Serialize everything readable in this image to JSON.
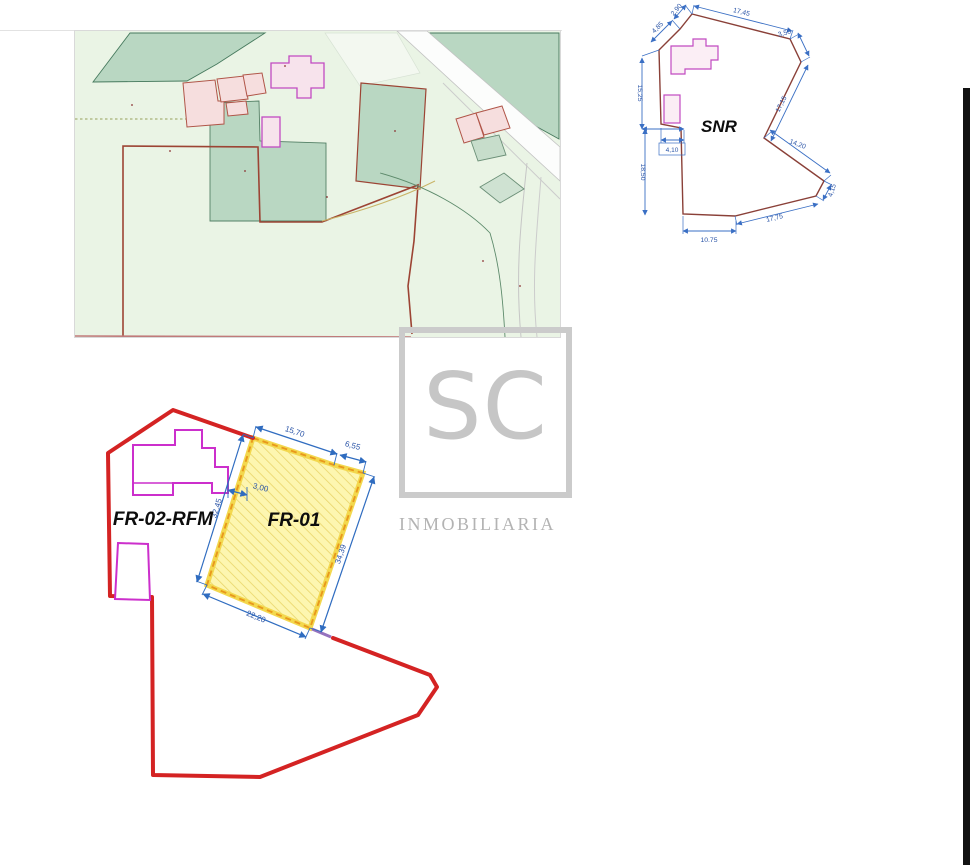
{
  "watermark": {
    "logo": "SC",
    "brand": "INMOBILIARIA"
  },
  "snr_plot": {
    "label": "SNR",
    "dims": {
      "edge_sw": "4,85",
      "edge_apex": "2,90",
      "edge_top": "17,45",
      "edge_ne": "3,50",
      "edge_east": "17,15",
      "edge_se1": "14,20",
      "edge_se2": "4,15",
      "edge_south": "17,75",
      "bottom": "10,75",
      "left_upper": "15,25",
      "left_lower": "18,50",
      "notch": "4,10"
    }
  },
  "subdivision_plan": {
    "labels": {
      "left_parcel": "FR-02-RFM",
      "right_parcel": "FR-01"
    },
    "dims": {
      "top": "15,70",
      "top_right": "6,55",
      "gap": "3,00",
      "west": "32,45",
      "east": "34,39",
      "south": "22,20"
    }
  },
  "palette": {
    "dimension_blue": "#2f6cc0",
    "plan_boundary_red": "#d42323",
    "snr_boundary_brown": "#8a4038",
    "parcel_fill_yellow": "#fdf6b0",
    "parcel_hatch_yellow": "#e9d569",
    "parcel_dash_orange": "#e8991c",
    "building_outline_magenta": "#cc2fcc",
    "map_field_green": "#eaf4e5",
    "map_parcel_green": "#b9d7c2",
    "map_boundary_red": "#9c4434",
    "map_building_pink": "#f6dede",
    "watermark_gray": "#c6c6c6"
  }
}
